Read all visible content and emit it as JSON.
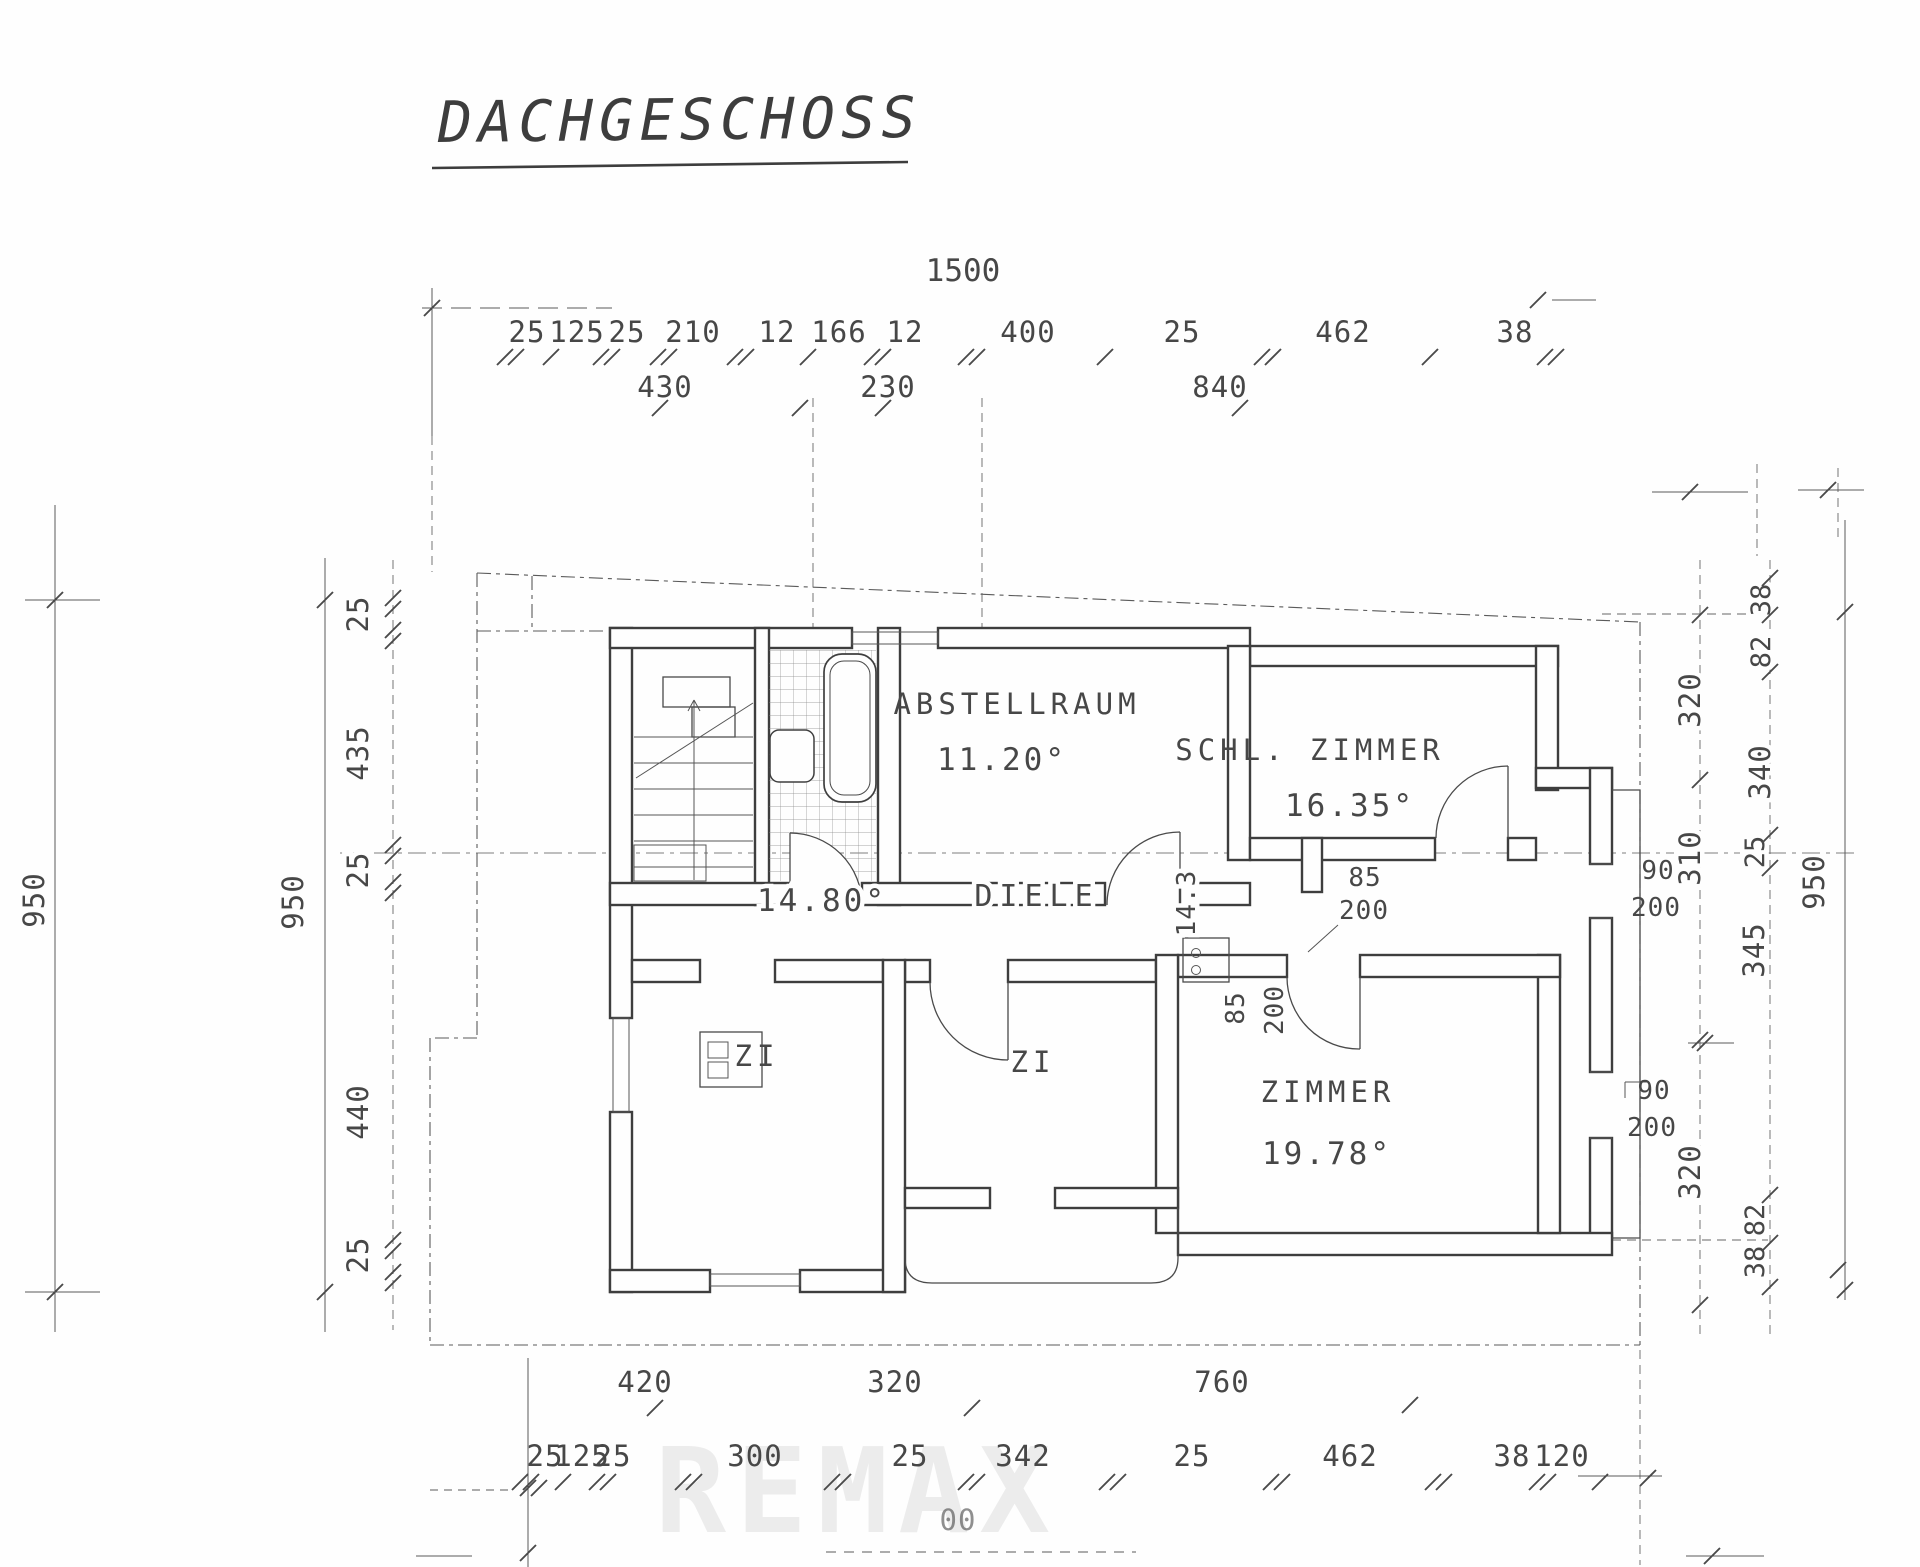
{
  "title": "DACHGESCHOSS",
  "watermark": "REMAX",
  "rooms": {
    "abstellraum": {
      "name": "ABSTELLRAUM",
      "area": "11.20°"
    },
    "schlafzimmer": {
      "name": "SCHL. ZIMMER",
      "area": "16.35°"
    },
    "diele": {
      "name": "DIELE",
      "area": "14.80°"
    },
    "zi_links": {
      "name": "ZI"
    },
    "zi_mitte": {
      "name": "ZI"
    },
    "zimmer": {
      "name": "ZIMMER",
      "area": "19.78°"
    }
  },
  "dims": {
    "top": {
      "overall": "1500",
      "row1": [
        "25",
        "125",
        "25",
        "210",
        "12",
        "166",
        "12",
        "400",
        "25",
        "462",
        "38"
      ],
      "row2": [
        "430",
        "230",
        "840"
      ]
    },
    "bottom": {
      "row1": [
        "420",
        "320",
        "760"
      ],
      "row2": [
        "25",
        "125",
        "25",
        "300",
        "25",
        "342",
        "25",
        "462",
        "38",
        "120"
      ],
      "partial": "00"
    },
    "left": {
      "outer": "950",
      "inner": "950",
      "chain": [
        "25",
        "435",
        "25",
        "440",
        "25"
      ]
    },
    "right": {
      "chain_inner": [
        "320",
        "310",
        "320"
      ],
      "chain_outer": [
        "38",
        "82",
        "340",
        "25",
        "345",
        "82",
        "38"
      ],
      "overall": "950"
    }
  },
  "doors": [
    {
      "w": "90",
      "h": "200"
    },
    {
      "w": "85",
      "h": "200"
    },
    {
      "w": "85",
      "h": "200"
    },
    {
      "w": "90",
      "h": "200"
    }
  ],
  "interior": {
    "diele_breite": "14.3"
  }
}
